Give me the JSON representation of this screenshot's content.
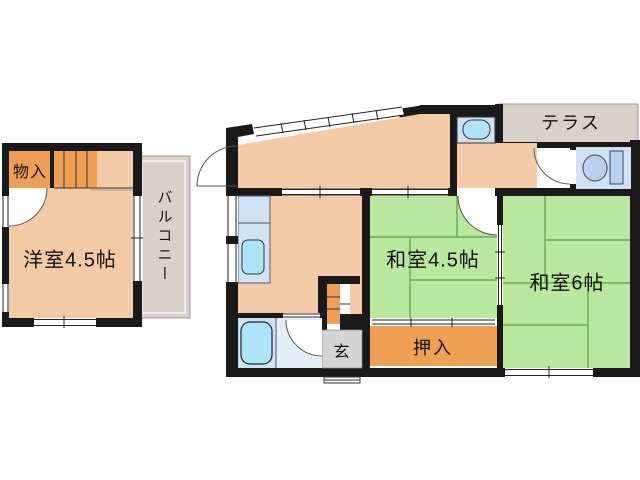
{
  "plan": {
    "rooms": {
      "storage": "物入",
      "western": "洋室4.5帖",
      "balcony": "バルコニー",
      "terrace": "テラス",
      "tatami45": "和室4.5帖",
      "tatami6": "和室6帖",
      "closet": "押入",
      "entry": "玄"
    }
  },
  "colors": {
    "wall": "#1a1a1a",
    "salmon": "#f2cba6",
    "orange": "#ef9f51",
    "green": "#b9e79d",
    "tatami_line": "#5f9e3f",
    "water": "#cfe2f3",
    "fixture": "#aee4f7",
    "washroom": "#e3edf7",
    "toilet_fixture": "#b7d1ec",
    "entry_gray": "#d4d4d4",
    "outdoor": "#d8d1c8",
    "line_dark": "#333333"
  }
}
